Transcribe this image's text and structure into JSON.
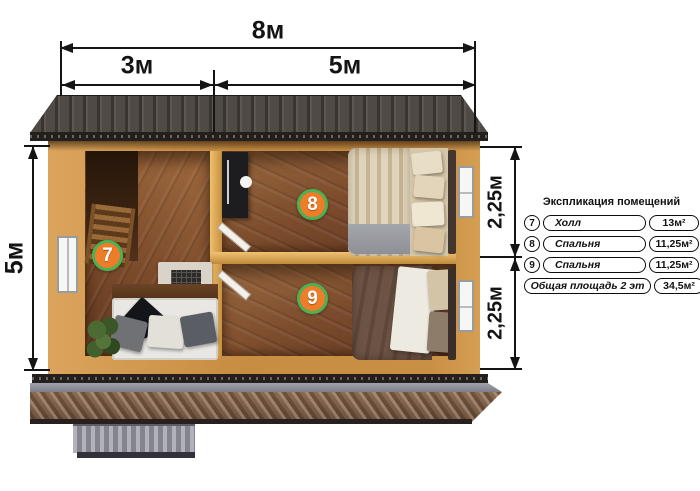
{
  "dims": {
    "top_total": "8м",
    "top_left": "3м",
    "top_right": "5м",
    "left": "5м",
    "right_top": "2,25м",
    "right_bottom": "2,25м"
  },
  "plan": {
    "badges": [
      "7",
      "8",
      "9"
    ]
  },
  "legend": {
    "title": "Экспликация помещений",
    "rows": [
      {
        "num": "7",
        "name": "Холл",
        "area": "13м²"
      },
      {
        "num": "8",
        "name": "Спальня",
        "area": "11,25м²"
      },
      {
        "num": "9",
        "name": "Спальня",
        "area": "11,25м²"
      }
    ],
    "total": {
      "name": "Общая площадь 2 эт",
      "area": "34,5м²"
    }
  },
  "colors": {
    "badge_fill": "#ee7d2a",
    "badge_border": "#4db053",
    "wall_wood": "#c98f45",
    "floor_wood": "#7a4a2b",
    "roof_top": "#46413c",
    "roof_bottom": "#7d5e48",
    "dim_line": "#141414"
  }
}
